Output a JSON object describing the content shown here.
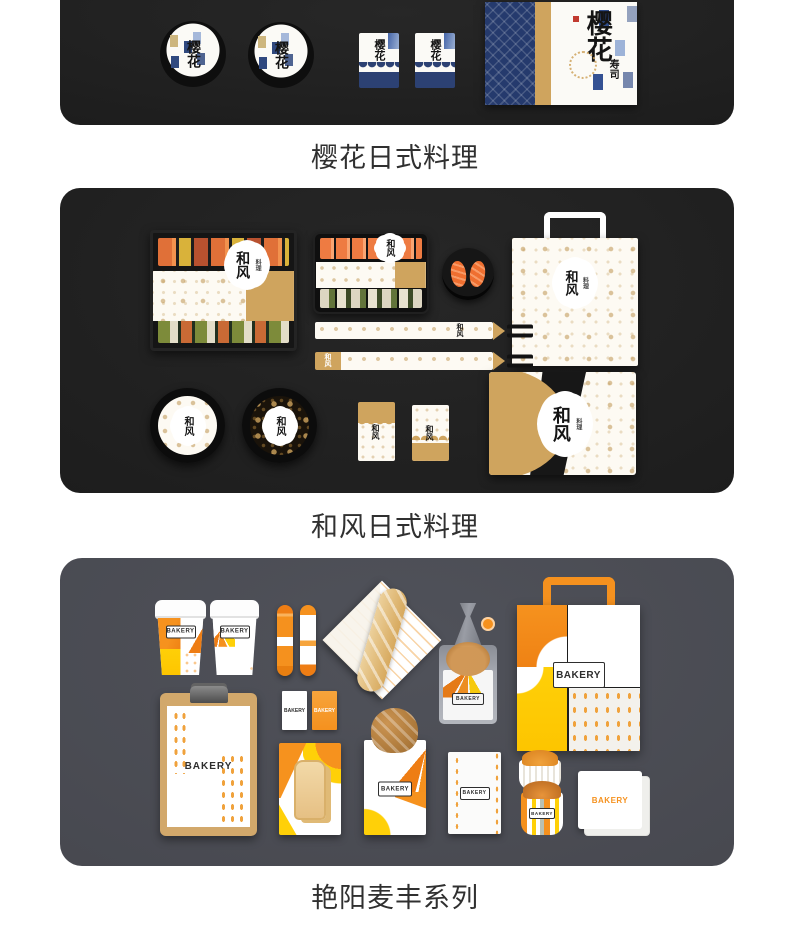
{
  "sections": {
    "sakura": {
      "caption": "樱花日式料理",
      "logo": "樱花",
      "logo_sub": "寿司"
    },
    "wafu": {
      "caption": "和风日式料理",
      "logo": "和风",
      "logo_sub": "料理"
    },
    "bakery": {
      "caption": "艳阳麦丰系列",
      "logo": "BAKERY"
    }
  },
  "colors": {
    "page_background": "#ffffff",
    "banner_dark": "#1f1f1f",
    "banner_gray": "#4a4b52",
    "caption_text": "#303030",
    "gold": "#cfa45e",
    "indigo": "#2c4173",
    "orange": "#f5911e",
    "yellow": "#ffd008",
    "seal_red": "#c13a30"
  }
}
